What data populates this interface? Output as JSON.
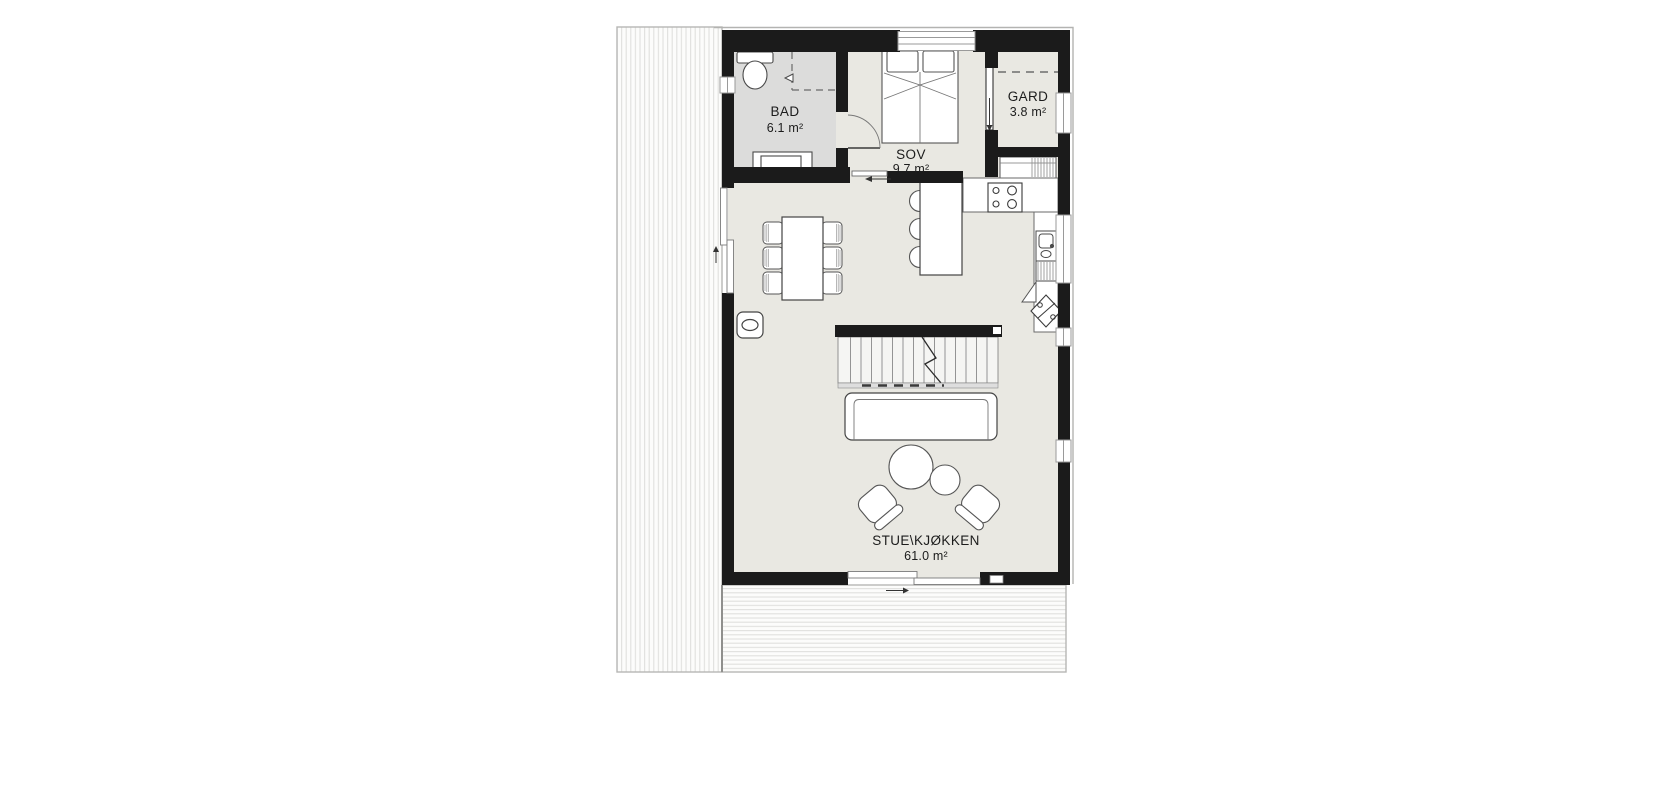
{
  "plan": {
    "type": "floor-plan",
    "rooms": [
      {
        "id": "bad",
        "label": "BAD",
        "area": "6.1 m²"
      },
      {
        "id": "sov",
        "label": "SOV",
        "area": "9.7 m²"
      },
      {
        "id": "gard",
        "label": "GARD",
        "area": "3.8 m²"
      },
      {
        "id": "stue_kjokken",
        "label": "STUE\\KJØKKEN",
        "area": "61.0 m²"
      }
    ],
    "colors": {
      "wall": "#1b1b1b",
      "floor_main": "#e9e8e2",
      "floor_bath": "#dcdcdb",
      "deck_stroke": "#b7b7b5",
      "fixture_stroke": "#4a4a4a",
      "label_text": "#1c1c1c"
    }
  }
}
